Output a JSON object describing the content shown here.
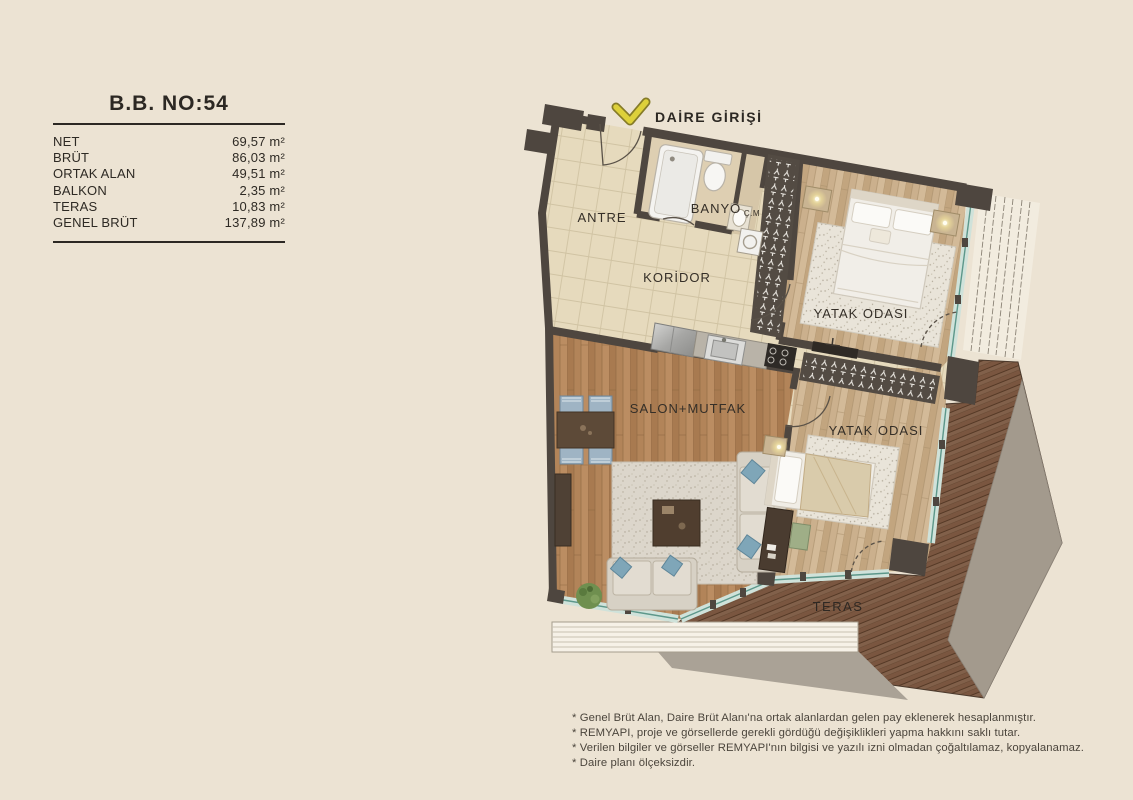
{
  "info_panel": {
    "title": "B.B. NO:54",
    "rows": [
      {
        "label": "NET",
        "value": "69,57 m²"
      },
      {
        "label": "BRÜT",
        "value": "86,03 m²"
      },
      {
        "label": "ORTAK ALAN",
        "value": "49,51 m²"
      },
      {
        "label": "BALKON",
        "value": "2,35 m²"
      },
      {
        "label": "TERAS",
        "value": "10,83 m²"
      },
      {
        "label": "GENEL BRÜT",
        "value": "137,89 m²"
      }
    ]
  },
  "entrance_label": "DAİRE GİRİŞİ",
  "rooms": {
    "antre": "ANTRE",
    "banyo": "BANYO",
    "cm": "Ç.M",
    "koridor": "KORİDOR",
    "bedroom1": "YATAK ODASI",
    "salon": "SALON+MUTFAK",
    "bedroom2": "YATAK ODASI",
    "teras": "TERAS"
  },
  "footnotes": [
    "* Genel Brüt Alan, Daire Brüt Alanı'na ortak alanlardan gelen pay eklenerek hesaplanmıştır.",
    "* REMYAPI, proje ve görsellerde gerekli gördüğü değişiklikleri yapma hakkını saklı tutar.",
    "* Verilen bilgiler ve görseller REMYAPI'nın bilgisi ve yazılı izni olmadan çoğaltılamaz, kopyalanamaz.",
    "* Daire planı ölçeksizdir."
  ],
  "colors": {
    "background": "#ece3d3",
    "wall": "#4e463f",
    "tile_floor": "#e6dabd",
    "salon_wood": "#b28459",
    "bedroom_wood": "#cbb08d",
    "terrace_deck": "#7a5640",
    "glass": "#5d978a",
    "accent_yellow": "#ddd03a"
  }
}
